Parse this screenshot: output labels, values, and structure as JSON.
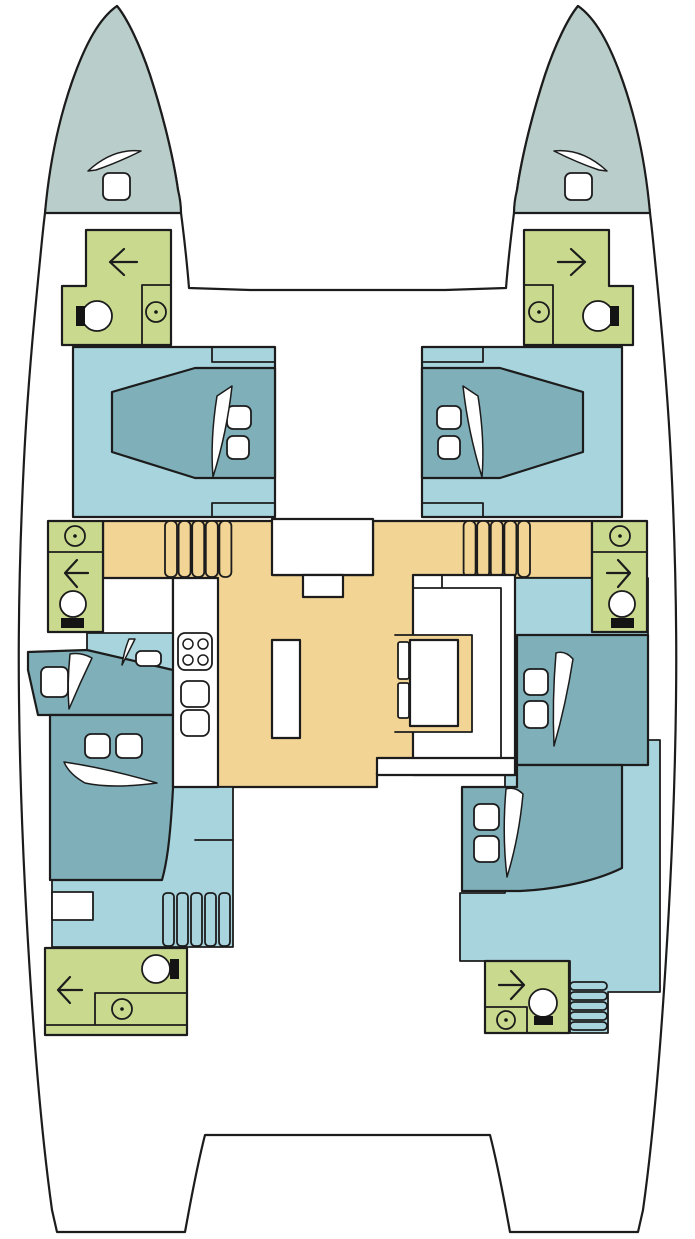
{
  "diagram": {
    "kind": "catamaran-interior-floorplan",
    "decks": [
      "bow-deck-port",
      "bow-deck-starboard",
      "salon",
      "port-hull",
      "starboard-hull"
    ]
  },
  "colors": {
    "paper": "#ffffff",
    "line": "#1c1c1c",
    "bow_deck": "#b9cdca",
    "cabin_floor": "#a8d4de",
    "bed": "#7fafb9",
    "bathroom": "#c9da8e",
    "salon_floor": "#f2d494",
    "furniture": "#ffffff",
    "ink": "#141414"
  },
  "icons": {
    "shower": "arrow",
    "toilet": "circle-with-tank",
    "sink": "circle-with-dot",
    "stove": "four-burner-grid",
    "hatch": "rounded-square",
    "door": "curved-blade",
    "stairs": "ribbed-bars",
    "pillow": "rounded-rect"
  }
}
